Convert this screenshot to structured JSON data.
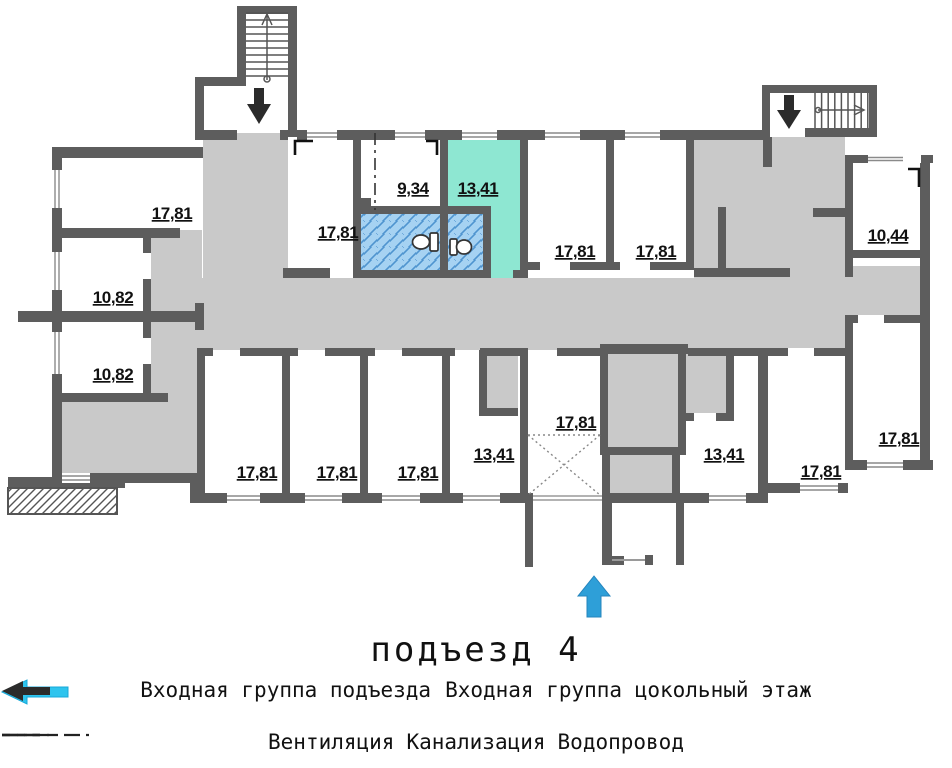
{
  "title": "подъезд 4",
  "plan": {
    "rooms": [
      {
        "id": "top-left-17-81",
        "area": "17,81"
      },
      {
        "id": "left-10-82-upper",
        "area": "10,82"
      },
      {
        "id": "left-10-82-lower",
        "area": "10,82"
      },
      {
        "id": "top-17-81-b",
        "area": "17,81"
      },
      {
        "id": "top-9-34",
        "area": "9,34"
      },
      {
        "id": "top-13-41-highlighted",
        "area": "13,41"
      },
      {
        "id": "top-17-81-c",
        "area": "17,81"
      },
      {
        "id": "top-17-81-d",
        "area": "17,81"
      },
      {
        "id": "right-10-44",
        "area": "10,44"
      },
      {
        "id": "bottom-17-81-e",
        "area": "17,81"
      },
      {
        "id": "bottom-17-81-f",
        "area": "17,81"
      },
      {
        "id": "bottom-17-81-g",
        "area": "17,81"
      },
      {
        "id": "bottom-13-41-h",
        "area": "13,41"
      },
      {
        "id": "bottom-17-81-shaft",
        "area": "17,81"
      },
      {
        "id": "bottom-13-41-j",
        "area": "13,41"
      },
      {
        "id": "bottom-17-81-k",
        "area": "17,81"
      },
      {
        "id": "right-17-81-l",
        "area": "17,81"
      }
    ],
    "highlight_room_area": "13,41",
    "colors": {
      "wall": "#5d5d5d",
      "corridor": "#c9c9c9",
      "highlight": "#8ee7d2",
      "wet_area": "#a6d2f2",
      "wet_hatch": "#4f94cf",
      "entry_arrow": "#2e9fd8",
      "legend_arrow_cyan": "#2ec4ee",
      "arrow_black": "#2b2b2b"
    }
  },
  "legend": {
    "entrance_group": {
      "label": "Входная группа подъезда"
    },
    "basement_group": {
      "label": "Входная группа цокольный этаж"
    },
    "lines": [
      {
        "id": "ventilation",
        "label": "Вентиляция",
        "style": "dash-dot"
      },
      {
        "id": "sewerage",
        "label": "Канализация",
        "style": "solid"
      },
      {
        "id": "water",
        "label": "Водопровод",
        "style": "dashed"
      }
    ]
  }
}
